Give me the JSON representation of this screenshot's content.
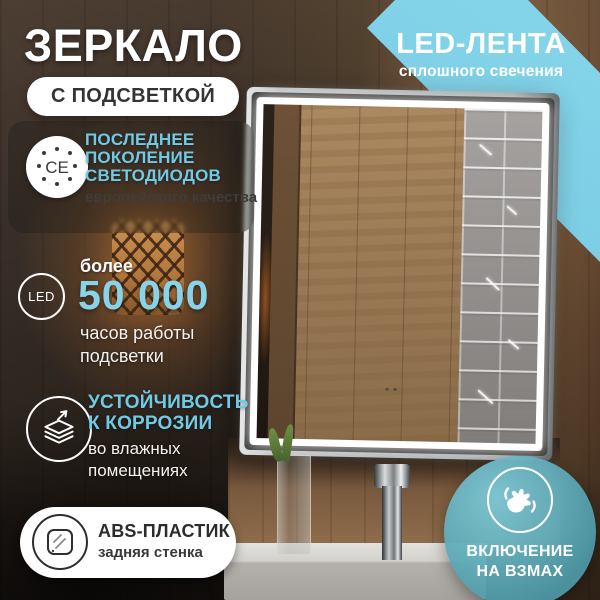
{
  "colors": {
    "accent_cyan": "#71CAE5",
    "ribbon_cyan": "#74C8E2",
    "badge_teal": "#5CAFBF",
    "led_white": "#FFFFFF",
    "text_dark": "#3A3937"
  },
  "header": {
    "title": "ЗЕРКАЛО",
    "pill": "С ПОДСВЕТКОЙ"
  },
  "ribbon": {
    "title": "LED-ЛЕНТА",
    "subtitle": "сплошного свечения"
  },
  "features": {
    "leds": {
      "icon": "ce-certified-icon",
      "icon_text": "CE",
      "line1": "ПОСЛЕДНЕЕ",
      "line2": "ПОКОЛЕНИЕ",
      "line3": "СВЕТОДИОДОВ",
      "subtitle": "европейского качества"
    },
    "hours": {
      "icon": "led-ring-icon",
      "icon_text": "LED",
      "pre": "более",
      "value": "50 000",
      "sub1": "часов работы",
      "sub2": "подсветки"
    },
    "corrosion": {
      "icon": "layers-arrow-icon",
      "line1": "УСТОЙЧИВОСТЬ",
      "line2": "К КОРРОЗИИ",
      "sub1": "во влажных",
      "sub2": "помещениях"
    },
    "abs": {
      "icon": "mirror-back-icon",
      "title": "ABS-ПЛАСТИК",
      "subtitle": "задняя стенка"
    }
  },
  "gesture_badge": {
    "icon": "waving-hand-icon",
    "line1": "ВКЛЮЧЕНИЕ",
    "line2": "НА ВЗМАХ"
  }
}
